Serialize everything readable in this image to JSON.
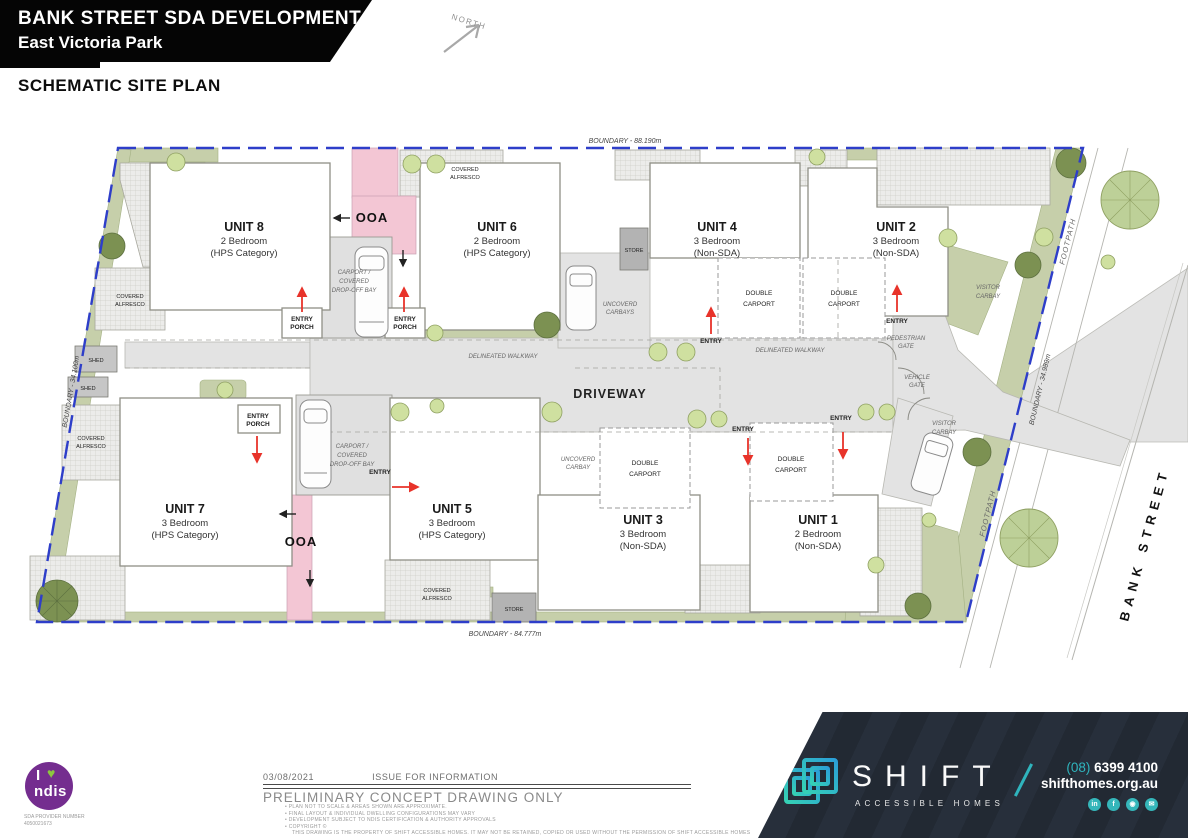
{
  "header": {
    "title_line1": "BANK STREET SDA DEVELOPMENT",
    "title_line2": "East Victoria Park",
    "subtitle": "SCHEMATIC SITE PLAN",
    "north_label": "NORTH"
  },
  "plan": {
    "boundaries": {
      "top": "BOUNDARY - 88.190m",
      "bottom": "BOUNDARY - 84.777m",
      "left": "BOUNDARY - 34.100m",
      "right": "BOUNDARY - 34.989m"
    },
    "streets": {
      "bank_street": "BANK STREET",
      "footpath": "FOOTPATH"
    },
    "driveway_label": "DRIVEWAY",
    "walkway_label": "DELINEATED WALKWAY",
    "units": [
      {
        "name": "UNIT 8",
        "beds": "2 Bedroom",
        "category": "(HPS Category)"
      },
      {
        "name": "UNIT 6",
        "beds": "2 Bedroom",
        "category": "(HPS Category)"
      },
      {
        "name": "UNIT 4",
        "beds": "3 Bedroom",
        "category": "(Non-SDA)"
      },
      {
        "name": "UNIT 2",
        "beds": "3 Bedroom",
        "category": "(Non-SDA)"
      },
      {
        "name": "UNIT 7",
        "beds": "3 Bedroom",
        "category": "(HPS Category)"
      },
      {
        "name": "UNIT 5",
        "beds": "3 Bedroom",
        "category": "(HPS Category)"
      },
      {
        "name": "UNIT 3",
        "beds": "3 Bedroom",
        "category": "(Non-SDA)"
      },
      {
        "name": "UNIT 1",
        "beds": "2 Bedroom",
        "category": "(Non-SDA)"
      }
    ],
    "features": {
      "ooa": "OOA",
      "carport_l1": "CARPORT /",
      "carport_l2": "COVERED",
      "carport_l3": "DROP-OFF BAY",
      "entry_porch_l1": "ENTRY",
      "entry_porch_l2": "PORCH",
      "entry": "ENTRY",
      "alfresco_l1": "COVERED",
      "alfresco_l2": "ALFRESCO",
      "double_carport_l1": "DOUBLE",
      "double_carport_l2": "CARPORT",
      "carbays_l1": "UNCOVERD",
      "carbays_l2": "CARBAYS",
      "carbay_l1": "UNCOVERD",
      "carbay_l2": "CARBAY",
      "visitor_l1": "VISITOR",
      "visitor_l2": "CARBAY",
      "ped_gate_l1": "PEDESTRIAN",
      "ped_gate_l2": "GATE",
      "veh_gate_l1": "VEHICLE",
      "veh_gate_l2": "GATE",
      "store": "STORE",
      "shed": "SHED"
    }
  },
  "footer": {
    "date": "03/08/2021",
    "issue": "ISSUE FOR INFORMATION",
    "preliminary": "PRELIMINARY CONCEPT DRAWING ONLY",
    "notes": [
      "PLAN NOT TO SCALE & AREAS SHOWN ARE APPROXIMATE.",
      "FINAL LAYOUT & INDIVIDUAL DWELLING CONFIGURATIONS MAY VARY",
      "DEVELOPMENT SUBJECT TO NDIS CERTIFICATION & AUTHORITY APPROVALS",
      "COPYRIGHT ©"
    ],
    "copyright_note": "THIS DRAWING IS THE PROPERTY OF SHIFT ACCESSIBLE HOMES.  IT MAY NOT BE RETAINED, COPIED OR USED WITHOUT THE PERMISSION OF SHIFT ACCESSIBLE HOMES",
    "ndis": {
      "i": "I",
      "heart": "♥",
      "name": "ndis",
      "caption_l1": "SDA PROVIDER NUMBER",
      "caption_l2": "4050021673"
    },
    "brand": {
      "name": "SHIFT",
      "tagline": "ACCESSIBLE HOMES",
      "phone_area": "(08)",
      "phone_number": "6399 4100",
      "website": "shifthomes.org.au",
      "social_icons": [
        "in",
        "f",
        "◉",
        "✉"
      ]
    }
  },
  "colors": {
    "boundary_blue": "#2e3ec9",
    "ooa_pink": "#f3c6d4",
    "landscape_green": "#c6cfaa",
    "paving_gray": "#e3e3e3",
    "arrow_red": "#e8332a",
    "banner_navy": "#232a35",
    "brand_teal": "#2fb4bd",
    "ndis_purple": "#742d8f",
    "ndis_green": "#8cc63f"
  }
}
